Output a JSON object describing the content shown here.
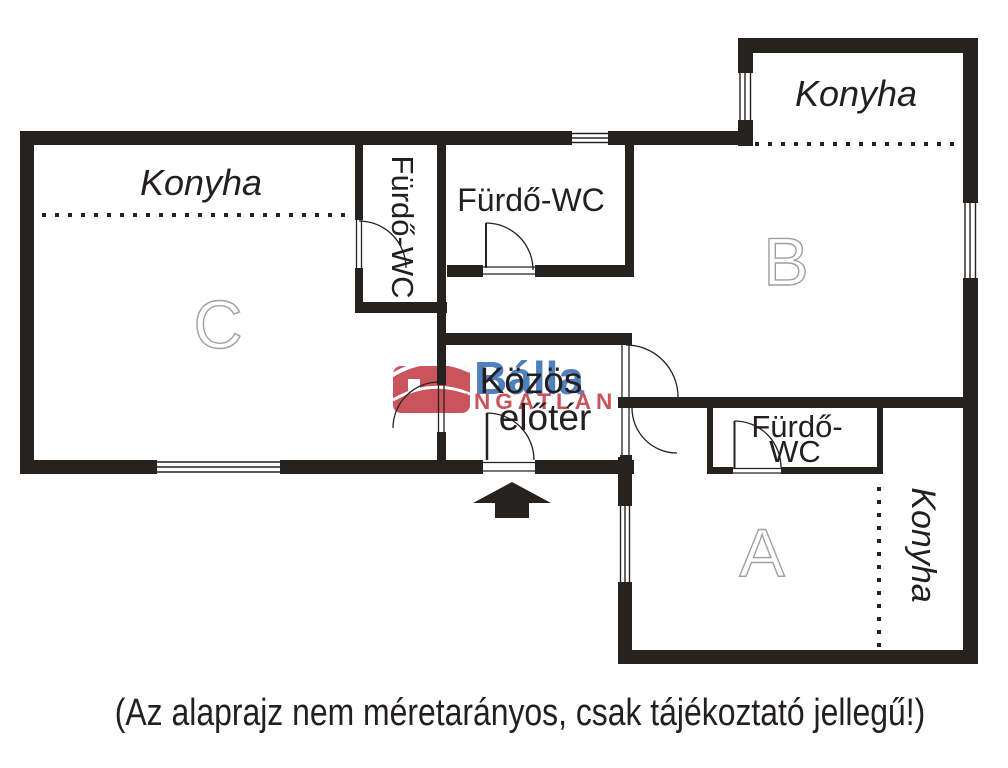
{
  "caption": "(Az alaprajz nem méretarányos, csak tájékoztató jellegű!)",
  "rooms": {
    "unit_a": "A",
    "unit_b": "B",
    "unit_c": "C",
    "kitchen_c": "Konyha",
    "kitchen_b": "Konyha",
    "kitchen_a": "Konyha",
    "bathroom_left_vertical": "Fürdő-WC",
    "bathroom_top_middle": "Fürdő-WC",
    "bathroom_a_line1": "Fürdő-",
    "bathroom_a_line2": "WC",
    "common_hall_line1": "Közös",
    "common_hall_line2": "előtér"
  },
  "watermark": {
    "brand": "Bálla",
    "brand_sub": "INGATLAN",
    "brand_color": "#4f81bd",
    "sub_color": "#c9545b",
    "house_color": "#c9545b"
  },
  "colors": {
    "wall": "#262220",
    "room_letter_outline": "#a0a0a0",
    "text": "#231f20"
  }
}
